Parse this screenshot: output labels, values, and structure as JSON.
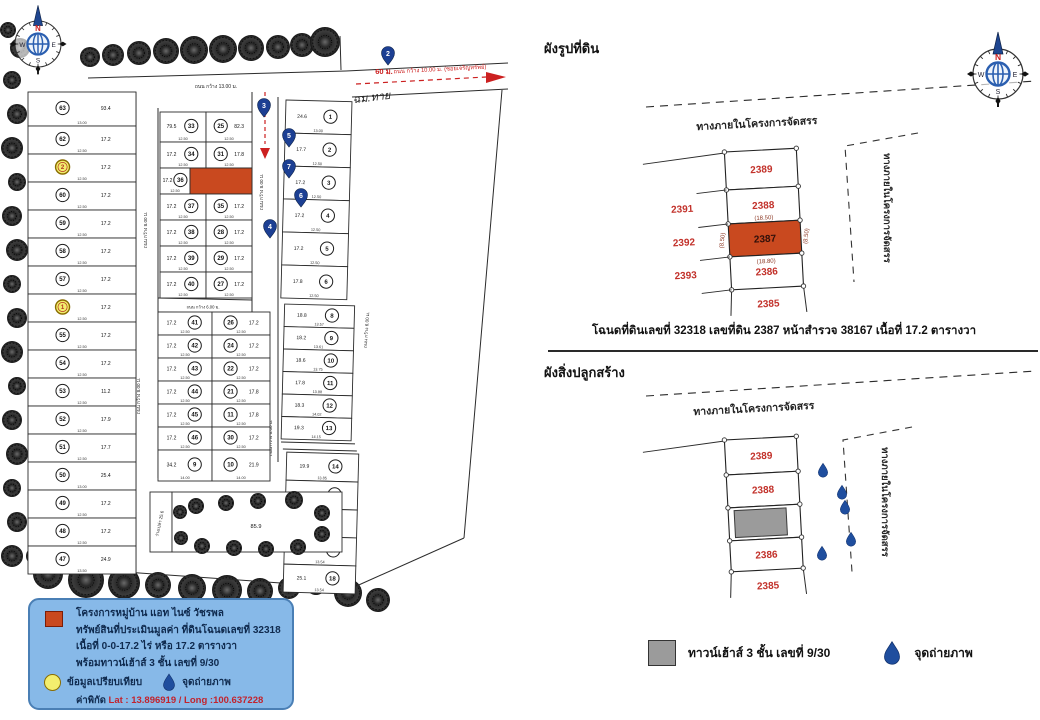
{
  "left_map": {
    "compass": {
      "n": "N",
      "e": "E",
      "s": "S",
      "w": "W"
    },
    "roads": {
      "top": "ถนน กว้าง 13.00 ม.",
      "left": "ถนน กว้าง 8.00 ม.",
      "center": "ถนน กว้าง 8.00 ม.",
      "cross": "ถนน กว้าง 6.00 ม.",
      "outer": "ถนน กว้าง 6.00 ม.",
      "entry": "ถนน กว้าง 10.00 ม. (ซอยเจริญทรัพย์)",
      "entry_length": "60 ม.",
      "handwritten_note": "ฉม.ทาย"
    },
    "left_column_lots": [
      {
        "no": "63",
        "area": "93.4",
        "dim": "13.00"
      },
      {
        "no": "62",
        "area": "17.2",
        "dim": "12.50"
      },
      {
        "no": "61",
        "area": "17.2",
        "dim": "12.50",
        "comp": "2"
      },
      {
        "no": "60",
        "area": "17.2",
        "dim": "12.50"
      },
      {
        "no": "59",
        "area": "17.2",
        "dim": "12.50"
      },
      {
        "no": "58",
        "area": "17.2",
        "dim": "12.50"
      },
      {
        "no": "57",
        "area": "17.2",
        "dim": "12.50"
      },
      {
        "no": "56",
        "area": "17.2",
        "dim": "12.50",
        "comp": "1"
      },
      {
        "no": "55",
        "area": "17.2",
        "dim": "12.50"
      },
      {
        "no": "54",
        "area": "17.2",
        "dim": "12.50"
      },
      {
        "no": "53",
        "area": "11.2",
        "dim": "12.50"
      },
      {
        "no": "52",
        "area": "17.9",
        "dim": "12.50"
      },
      {
        "no": "51",
        "area": "17.7",
        "dim": "12.50"
      },
      {
        "no": "50",
        "area": "25.4",
        "dim": "13.00"
      },
      {
        "no": "49",
        "area": "17.2",
        "dim": "12.50"
      },
      {
        "no": "48",
        "area": "17.2",
        "dim": "12.50"
      },
      {
        "no": "47",
        "area": "24.9",
        "dim": "13.50"
      }
    ],
    "upper_block_rows": [
      {
        "left": {
          "no": "33",
          "area": "79.5"
        },
        "right": {
          "no": "25",
          "area": "82.3"
        }
      },
      {
        "left": {
          "no": "34",
          "area": "17.2"
        },
        "right": {
          "no": "31",
          "area": "17.8"
        }
      },
      {
        "left": {
          "no": "36",
          "area": "17.2"
        },
        "right": {
          "subject": true
        }
      },
      {
        "left": {
          "no": "37",
          "area": "17.2"
        },
        "right": {
          "no": "35",
          "area": "17.2"
        }
      },
      {
        "left": {
          "no": "38",
          "area": "17.2"
        },
        "right": {
          "no": "28",
          "area": "17.2"
        }
      },
      {
        "left": {
          "no": "39",
          "area": "17.2"
        },
        "right": {
          "no": "29",
          "area": "17.2"
        }
      },
      {
        "left": {
          "no": "40",
          "area": "17.2"
        },
        "right": {
          "no": "27",
          "area": "17.2"
        }
      }
    ],
    "lower_block_rows": [
      {
        "left": {
          "no": "41",
          "area": "17.2"
        },
        "right": {
          "no": "26",
          "area": "17.2"
        }
      },
      {
        "left": {
          "no": "42",
          "area": "17.2"
        },
        "right": {
          "no": "24",
          "area": "17.2"
        }
      },
      {
        "left": {
          "no": "43",
          "area": "17.2"
        },
        "right": {
          "no": "22",
          "area": "17.2"
        }
      },
      {
        "left": {
          "no": "44",
          "area": "17.2"
        },
        "right": {
          "no": "21",
          "area": "17.8"
        }
      },
      {
        "left": {
          "no": "45",
          "area": "17.2"
        },
        "right": {
          "no": "11",
          "area": "17.8"
        }
      },
      {
        "left": {
          "no": "46",
          "area": "17.2"
        },
        "right": {
          "no": "30",
          "area": "17.2"
        }
      },
      {
        "left": {
          "no": "9",
          "area": "34.2",
          "dim": "14.00"
        },
        "right": {
          "no": "10",
          "area": "21.9",
          "dim": "14.00"
        }
      }
    ],
    "right_strip_a": [
      {
        "no": "1",
        "area": "24.6",
        "dim": "13.00"
      },
      {
        "no": "2",
        "area": "17.7",
        "dim": "12.50"
      },
      {
        "no": "3",
        "area": "17.2",
        "dim": "12.50"
      },
      {
        "no": "4",
        "area": "17.2",
        "dim": "12.50"
      },
      {
        "no": "5",
        "area": "17.2",
        "dim": "12.50"
      },
      {
        "no": "6",
        "area": "17.8",
        "dim": "12.50"
      }
    ],
    "right_strip_b": [
      {
        "no": "8",
        "area": "18.8",
        "dim": "13.57"
      },
      {
        "no": "9",
        "area": "18.2",
        "dim": "13.61"
      },
      {
        "no": "10",
        "area": "18.6",
        "dim": "13.75"
      },
      {
        "no": "11",
        "area": "17.8",
        "dim": "13.88"
      },
      {
        "no": "12",
        "area": "18.3",
        "dim": "14.02"
      },
      {
        "no": "13",
        "area": "19.3",
        "dim": "14.15"
      }
    ],
    "right_strip_c": [
      {
        "no": "14",
        "area": "19.9",
        "dim": "13.85"
      },
      {
        "no": "15",
        "area": "18.1",
        "dim": "13.80"
      },
      {
        "no": "16",
        "area": "34.9",
        "dim": "13.85"
      },
      {
        "no": "17",
        "area": "17.6",
        "dim": "13.54"
      },
      {
        "no": "18",
        "area": "25.1",
        "dim": "13.54"
      }
    ],
    "photo_pins": [
      {
        "no": "2"
      },
      {
        "no": "3"
      },
      {
        "no": "5"
      },
      {
        "no": "7"
      },
      {
        "no": "6"
      },
      {
        "no": "4"
      }
    ],
    "common_area": {
      "orchard_area": "85.9",
      "vacant_label": "ว่างเปล่า 25.6"
    },
    "legend": {
      "lines": [
        "โครงการหมู่บ้าน แอท ไนซ์ วัชรพล",
        "ทรัพย์สินที่ประเมินมูลค่า ที่ดินโฉนดเลขที่ 32318",
        "เนื้อที่ 0-0-17.2 ไร่ หรือ 17.2 ตารางวา",
        "พร้อมทาวน์เฮ้าส์ 3 ชั้น เลขที่ 9/30"
      ],
      "comparison_label": "ข้อมูลเปรียบเทียบ",
      "photo_label": "จุดถ่ายภาพ",
      "coords_prefix": "ค่าพิกัด",
      "lat_label": "Lat",
      "lat_value": ": 13.896919",
      "slash": "/",
      "long_label": "Long",
      "long_value": ":100.637228"
    }
  },
  "right_page": {
    "title_land": "ผังรูปที่ดิน",
    "title_building": "ผังสิ่งปลูกสร้าง",
    "road_label": "ทางภายในโครงการจัดสรร",
    "side_road_label": "ทางภายในโครงการจัดสรร",
    "compass": {
      "n": "N",
      "e": "E",
      "s": "S",
      "w": "W"
    },
    "plots": [
      "2389",
      "2388",
      "2387",
      "2386",
      "2385"
    ],
    "adjacent_plots": [
      "2391",
      "2392",
      "2393"
    ],
    "subject_plot": "2387",
    "dims": {
      "top": "(18.50)",
      "bottom": "(18.80)",
      "left": "(8.50)",
      "right": "(8.50)"
    },
    "caption": "โฉนดที่ดินเลขที่ 32318 เลขที่ดิน 2387 หน้าสำรวจ 38167  เนื้อที่ 17.2 ตารางวา",
    "legend": {
      "house": "ทาวน์เฮ้าส์ 3 ชั้น เลขที่ 9/30",
      "photo": "จุดถ่ายภาพ"
    }
  },
  "colors": {
    "subject_red": "#c9491f",
    "plot_number_red": "#c2312a",
    "dim_maroon": "#8d3a26",
    "legend_bg": "#87b9e8",
    "pin_blue": "#1c3f93",
    "drop_blue": "#1f4e9e",
    "compass_blue": "#2b5fb0",
    "north_red": "#cc2020",
    "building_gray": "#9b9b9b",
    "comparison_yellow": "#f3ee6e",
    "line_dark": "#2b2b2b",
    "red_road": "#cc2020"
  }
}
